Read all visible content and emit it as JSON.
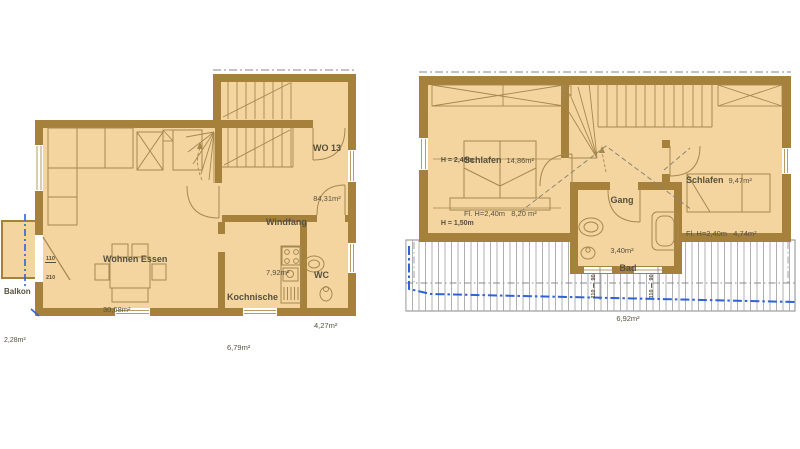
{
  "colors": {
    "wall": "#a5813c",
    "floor": "#f4d5a0",
    "line": "#a5884e",
    "text": "#56503e",
    "boundary_blue": "#2f62d6",
    "hatch_gray": "#9b9b9b"
  },
  "ground_floor": {
    "unit": {
      "name": "WO 13",
      "area": "84,31m²"
    },
    "rooms": {
      "wohnen": {
        "name": "Wohnen Essen",
        "area": "30,68m²"
      },
      "windfang": {
        "name": "Windfang",
        "area": "7,92m²"
      },
      "kochnische": {
        "name": "Kochnische",
        "area": "6,79m²"
      },
      "wc": {
        "name": "WC",
        "area": "4,27m²"
      },
      "balkon": {
        "name": "Balkon",
        "area": "2,28m²"
      }
    },
    "balcony_door_dim": {
      "width": "110",
      "height": "210"
    }
  },
  "upper_floor": {
    "rooms": {
      "schlafen_left": {
        "name": "Schlafen",
        "area": "14,86m²",
        "detail": "Fl. H=2,40m   8,20 m²"
      },
      "schlafen_right": {
        "name": "Schlafen",
        "area": "9,47m²",
        "detail": "Fl. H=2,40m   4,74m²"
      },
      "gang": {
        "name": "Gang",
        "area": "3,40m²"
      },
      "bad": {
        "name": "Bad",
        "area": "6,92m²"
      }
    },
    "height_labels": {
      "upper": "H = 2,40m",
      "lower": "H = 1,50m"
    },
    "window_dims": [
      {
        "w": "110",
        "h": "90"
      },
      {
        "w": "110",
        "h": "90"
      }
    ]
  }
}
